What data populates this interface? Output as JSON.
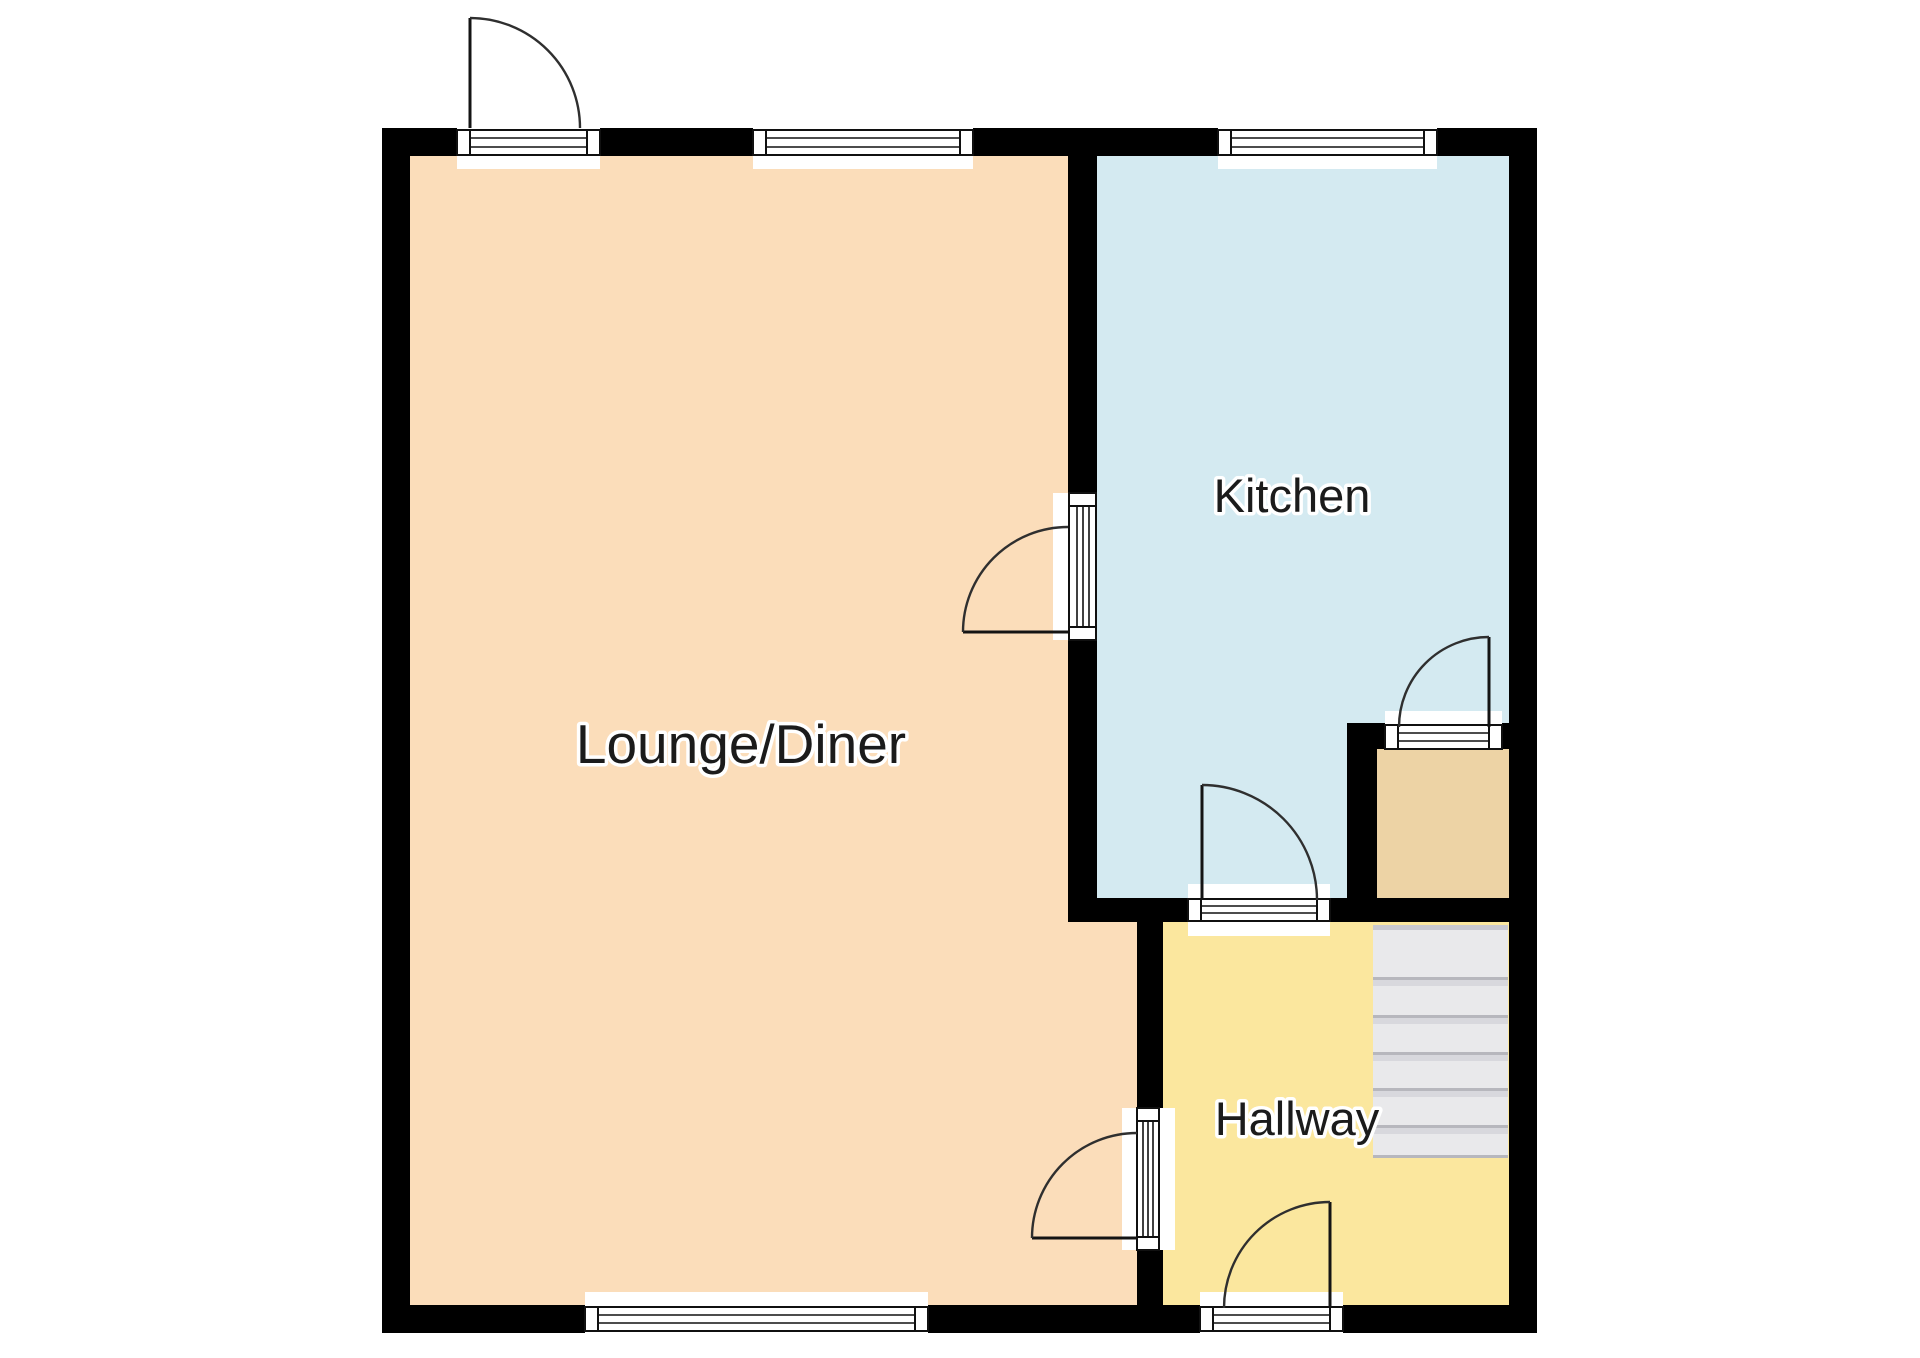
{
  "plan": {
    "type": "ground-floor-plan",
    "background": "#FFFFFF",
    "wall_color": "#000000",
    "label_color": "#1B1B1B",
    "label_halo": "#FFFFFF"
  },
  "rooms": {
    "lounge": {
      "label": "Lounge/Diner",
      "floor_color": "#FBDDBA"
    },
    "kitchen": {
      "label": "Kitchen",
      "floor_color": "#D4EAF1"
    },
    "hallway": {
      "label": "Hallway",
      "floor_color": "#FBE79E"
    },
    "store": {
      "floor_color": "#EDD3A5"
    }
  },
  "stairs": {
    "tread_color": "#E9E9EB",
    "tread_edge_color": "#B7B7BD",
    "tread_shadow_color": "#D8D8DD"
  }
}
